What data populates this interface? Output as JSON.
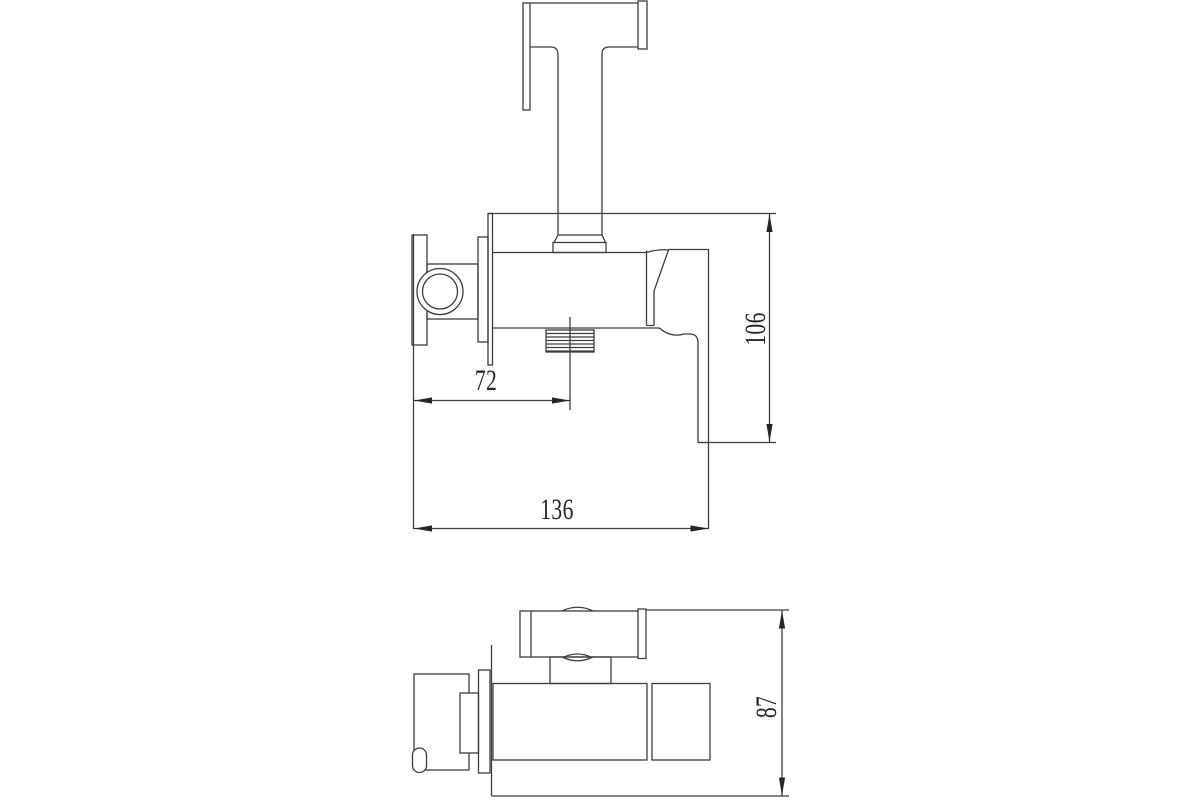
{
  "page": {
    "background_color": "#ffffff",
    "line_color": "#3d3d3d"
  },
  "views": {
    "front_view": {
      "name": "front-view",
      "dimensions": {
        "outlet_offset": {
          "value": "72",
          "orientation": "horizontal"
        },
        "height": {
          "value": "106",
          "orientation": "vertical"
        },
        "total_depth": {
          "value": "136",
          "orientation": "horizontal"
        }
      }
    },
    "top_view": {
      "name": "top-view",
      "dimensions": {
        "depth": {
          "value": "87",
          "orientation": "vertical"
        }
      }
    }
  }
}
